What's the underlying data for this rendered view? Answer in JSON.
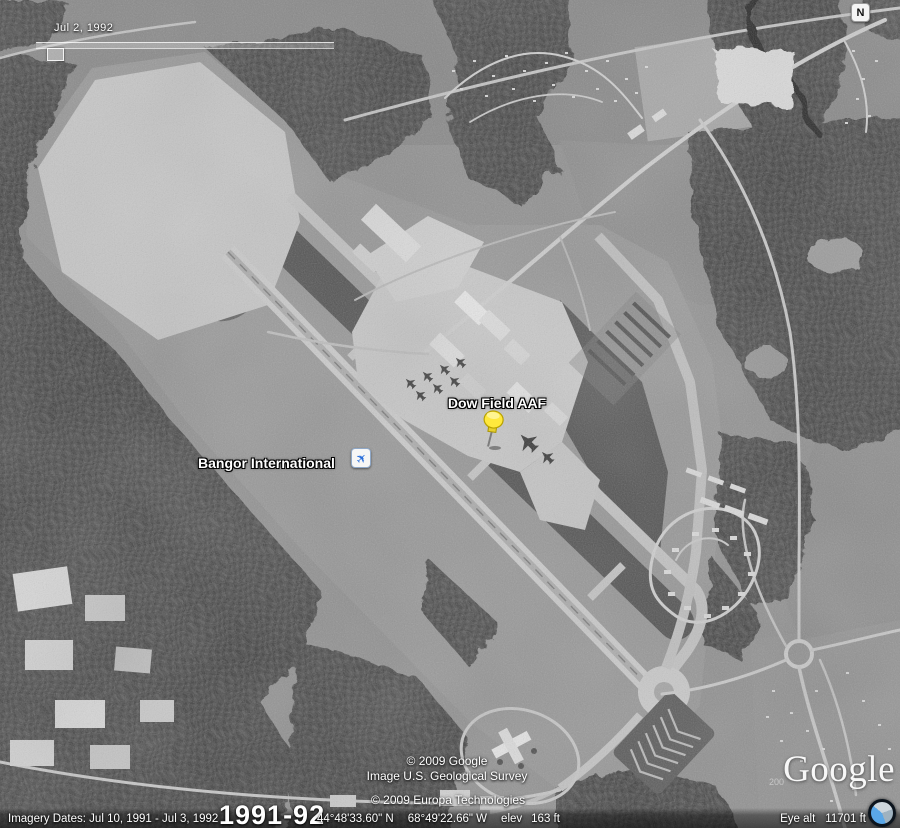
{
  "time_slider": {
    "date": "Jul 2, 1992"
  },
  "compass": {
    "label": "N"
  },
  "placemarks": {
    "dow": {
      "label": "Dow Field AAF"
    },
    "bangor": {
      "label": "Bangor International",
      "icon_glyph": "✈"
    }
  },
  "attribution": {
    "google": "© 2009 Google",
    "usgs": "Image U.S. Geological Survey",
    "europa": "© 2009 Europa Technologies",
    "logo_text": "Google",
    "faded_year": "200"
  },
  "status_bar": {
    "imagery_dates": "Imagery Dates:  Jul 10, 1991 - Jul 3, 1992",
    "year_range": "1991-92",
    "latitude": "44°48'33.60\" N",
    "longitude": "68°49'22.66\" W",
    "elev_label": "elev",
    "elevation": "163 ft",
    "eye_alt_label": "Eye alt",
    "eye_altitude": "11701 ft"
  },
  "colors": {
    "pushpin_yellow": "#ffe83d",
    "airport_icon_blue": "#2a6fdb",
    "overlay_text": "#ffffff"
  }
}
